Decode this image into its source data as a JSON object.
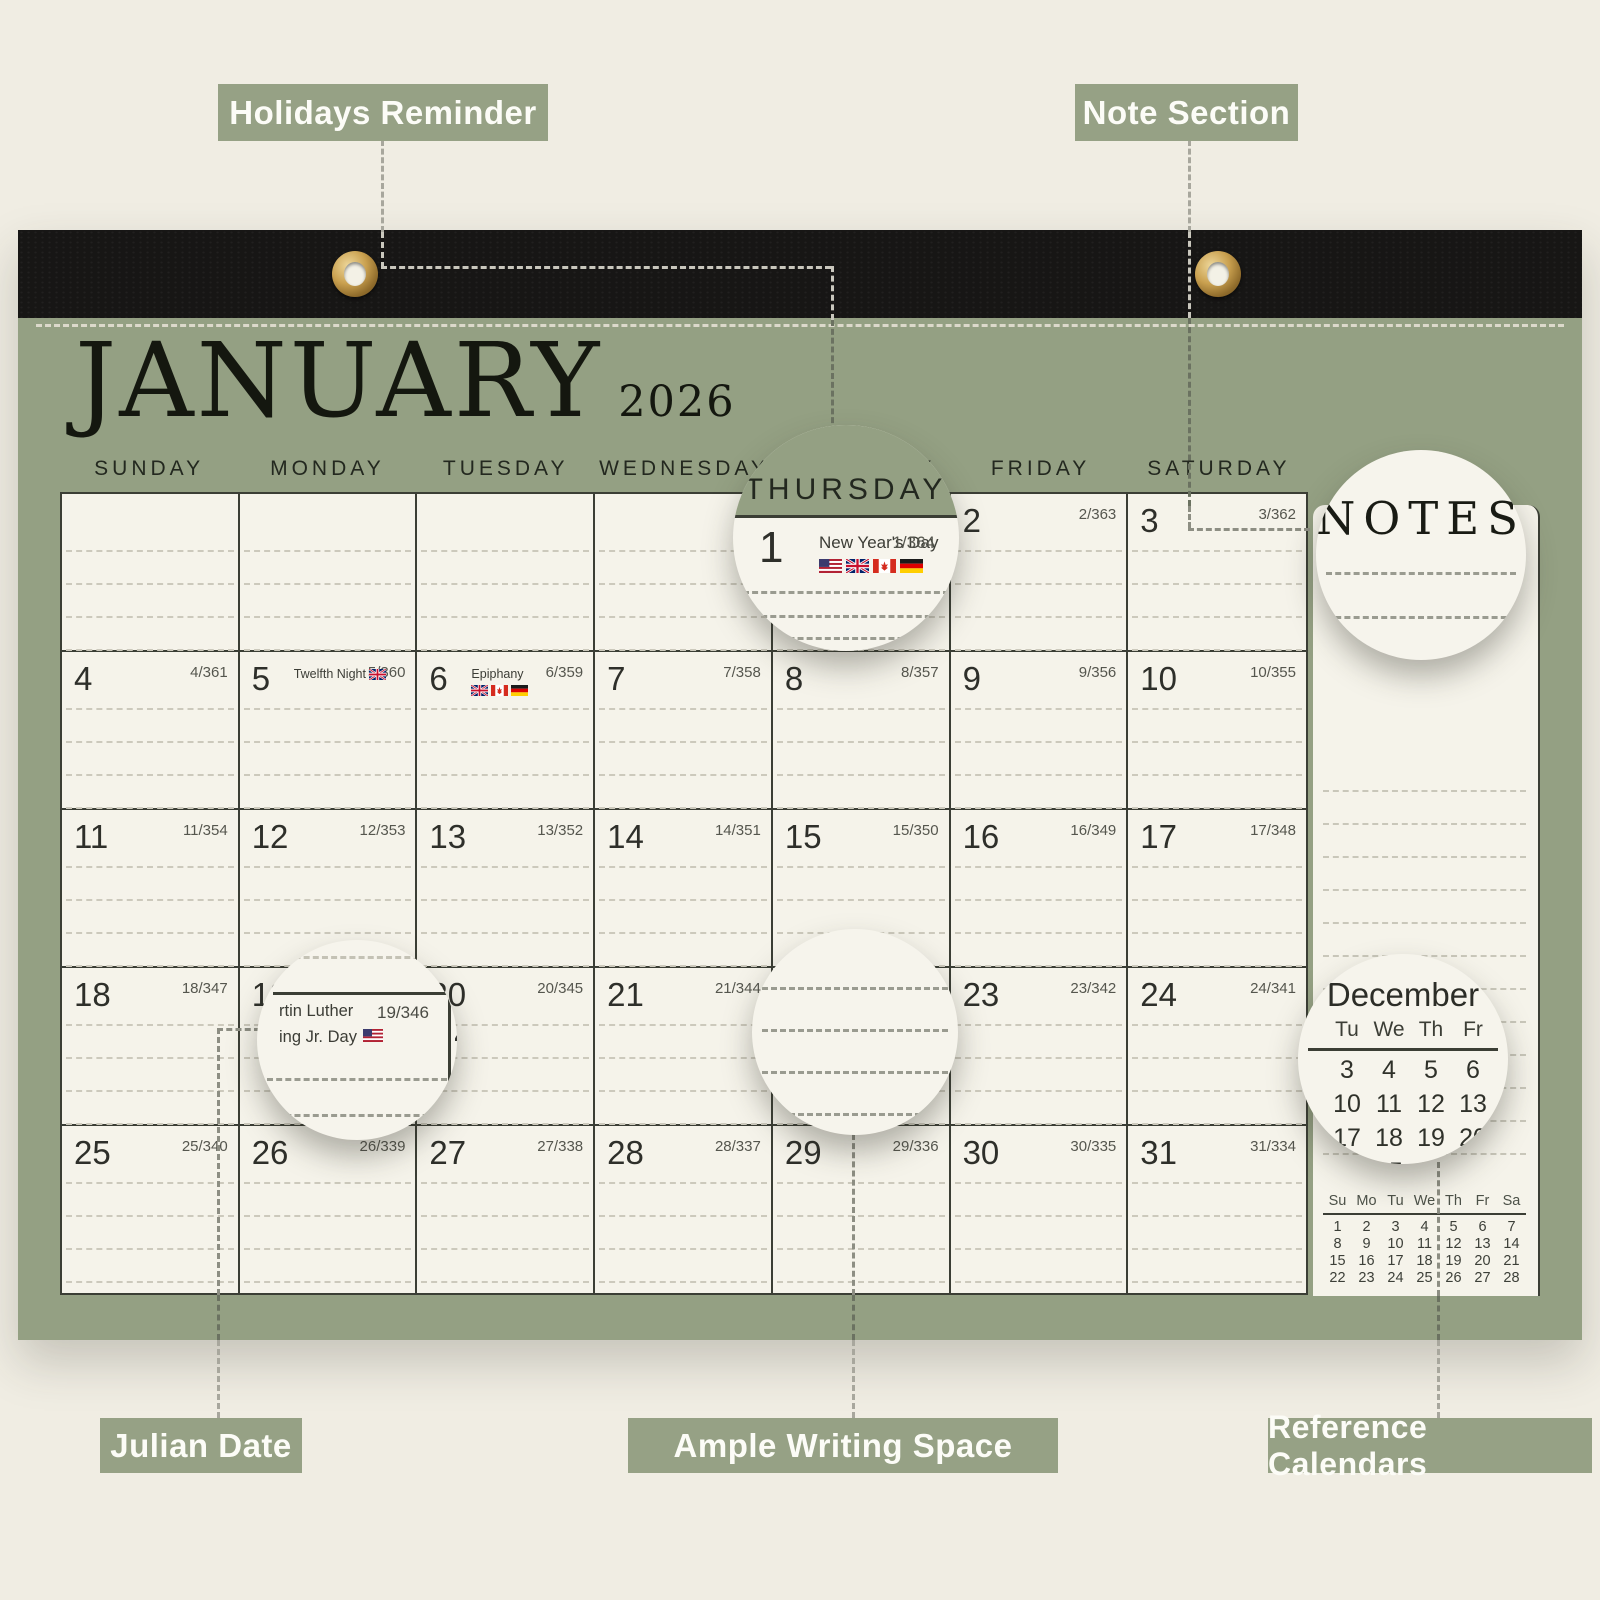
{
  "colors": {
    "background": "#f0ede3",
    "pad_green": "#94a083",
    "label_green": "#96a185",
    "strip_black": "#171615",
    "paper": "#f5f3ea",
    "grid_line": "#3b3e35",
    "grommet_gold": "#c9a04f"
  },
  "labels": {
    "holidays": "Holidays Reminder",
    "note_section": "Note Section",
    "julian": "Julian Date",
    "writing": "Ample Writing Space",
    "reference": "Reference Calendars"
  },
  "calendar": {
    "month": "JANUARY",
    "year": "2026",
    "day_headers": [
      "SUNDAY",
      "MONDAY",
      "TUESDAY",
      "WEDNESDAY",
      "THURSDAY",
      "FRIDAY",
      "SATURDAY"
    ],
    "notes_title": "NOTES",
    "weeks": [
      [
        {
          "date": "",
          "julian": ""
        },
        {
          "date": "",
          "julian": ""
        },
        {
          "date": "",
          "julian": ""
        },
        {
          "date": "",
          "julian": ""
        },
        {
          "date": "1",
          "julian": "1/364",
          "holiday": "New Year's Day",
          "flags": [
            "flag-us",
            "flag-uk",
            "flag-ca",
            "flag-de"
          ]
        },
        {
          "date": "2",
          "julian": "2/363"
        },
        {
          "date": "3",
          "julian": "3/362"
        }
      ],
      [
        {
          "date": "4",
          "julian": "4/361"
        },
        {
          "date": "5",
          "julian": "5/360",
          "holiday": "Twelfth Night",
          "flags": [
            "flag-uk"
          ]
        },
        {
          "date": "6",
          "julian": "6/359",
          "holiday": "Epiphany",
          "flags": [
            "flag-uk",
            "flag-ca",
            "flag-de"
          ]
        },
        {
          "date": "7",
          "julian": "7/358"
        },
        {
          "date": "8",
          "julian": "8/357"
        },
        {
          "date": "9",
          "julian": "9/356"
        },
        {
          "date": "10",
          "julian": "10/355"
        }
      ],
      [
        {
          "date": "11",
          "julian": "11/354"
        },
        {
          "date": "12",
          "julian": "12/353"
        },
        {
          "date": "13",
          "julian": "13/352"
        },
        {
          "date": "14",
          "julian": "14/351"
        },
        {
          "date": "15",
          "julian": "15/350"
        },
        {
          "date": "16",
          "julian": "16/349"
        },
        {
          "date": "17",
          "julian": "17/348"
        }
      ],
      [
        {
          "date": "18",
          "julian": "18/347"
        },
        {
          "date": "19",
          "julian": "19/346",
          "holiday": "Martin Luther King Jr. Day",
          "flags": [
            "flag-us"
          ]
        },
        {
          "date": "20",
          "julian": "20/345"
        },
        {
          "date": "21",
          "julian": "21/344"
        },
        {
          "date": "22",
          "julian": "22/343"
        },
        {
          "date": "23",
          "julian": "23/342"
        },
        {
          "date": "24",
          "julian": "24/341"
        }
      ],
      [
        {
          "date": "25",
          "julian": "25/340"
        },
        {
          "date": "26",
          "julian": "26/339"
        },
        {
          "date": "27",
          "julian": "27/338"
        },
        {
          "date": "28",
          "julian": "28/337"
        },
        {
          "date": "29",
          "julian": "29/336"
        },
        {
          "date": "30",
          "julian": "30/335"
        },
        {
          "date": "31",
          "julian": "31/334"
        }
      ]
    ],
    "mini_february": {
      "headers": [
        "Su",
        "Mo",
        "Tu",
        "We",
        "Th",
        "Fr",
        "Sa"
      ],
      "rows": [
        [
          "1",
          "2",
          "3",
          "4",
          "5",
          "6",
          "7"
        ],
        [
          "8",
          "9",
          "10",
          "11",
          "12",
          "13",
          "14"
        ],
        [
          "15",
          "16",
          "17",
          "18",
          "19",
          "20",
          "21"
        ],
        [
          "22",
          "23",
          "24",
          "25",
          "26",
          "27",
          "28"
        ]
      ]
    }
  },
  "magnifiers": {
    "thursday": {
      "day_header": "THURSDAY",
      "date": "1",
      "holiday": "New Year's Day",
      "julian": "1/364",
      "flags": [
        "flag-us",
        "flag-uk",
        "flag-ca",
        "flag-de"
      ]
    },
    "notes": {
      "title": "NOTES"
    },
    "mlk": {
      "line1": "rtin Luther",
      "line2": "ing Jr. Day",
      "julian": "19/346",
      "flag": "flag-us",
      "partial_next_date": "2"
    },
    "december": {
      "title": "December",
      "headers": [
        "Tu",
        "We",
        "Th",
        "Fr"
      ],
      "rows": [
        [
          "3",
          "4",
          "5",
          "6"
        ],
        [
          "10",
          "11",
          "12",
          "13"
        ],
        [
          "17",
          "18",
          "19",
          "20"
        ],
        [
          "24",
          "25",
          "26",
          "27"
        ]
      ]
    }
  }
}
